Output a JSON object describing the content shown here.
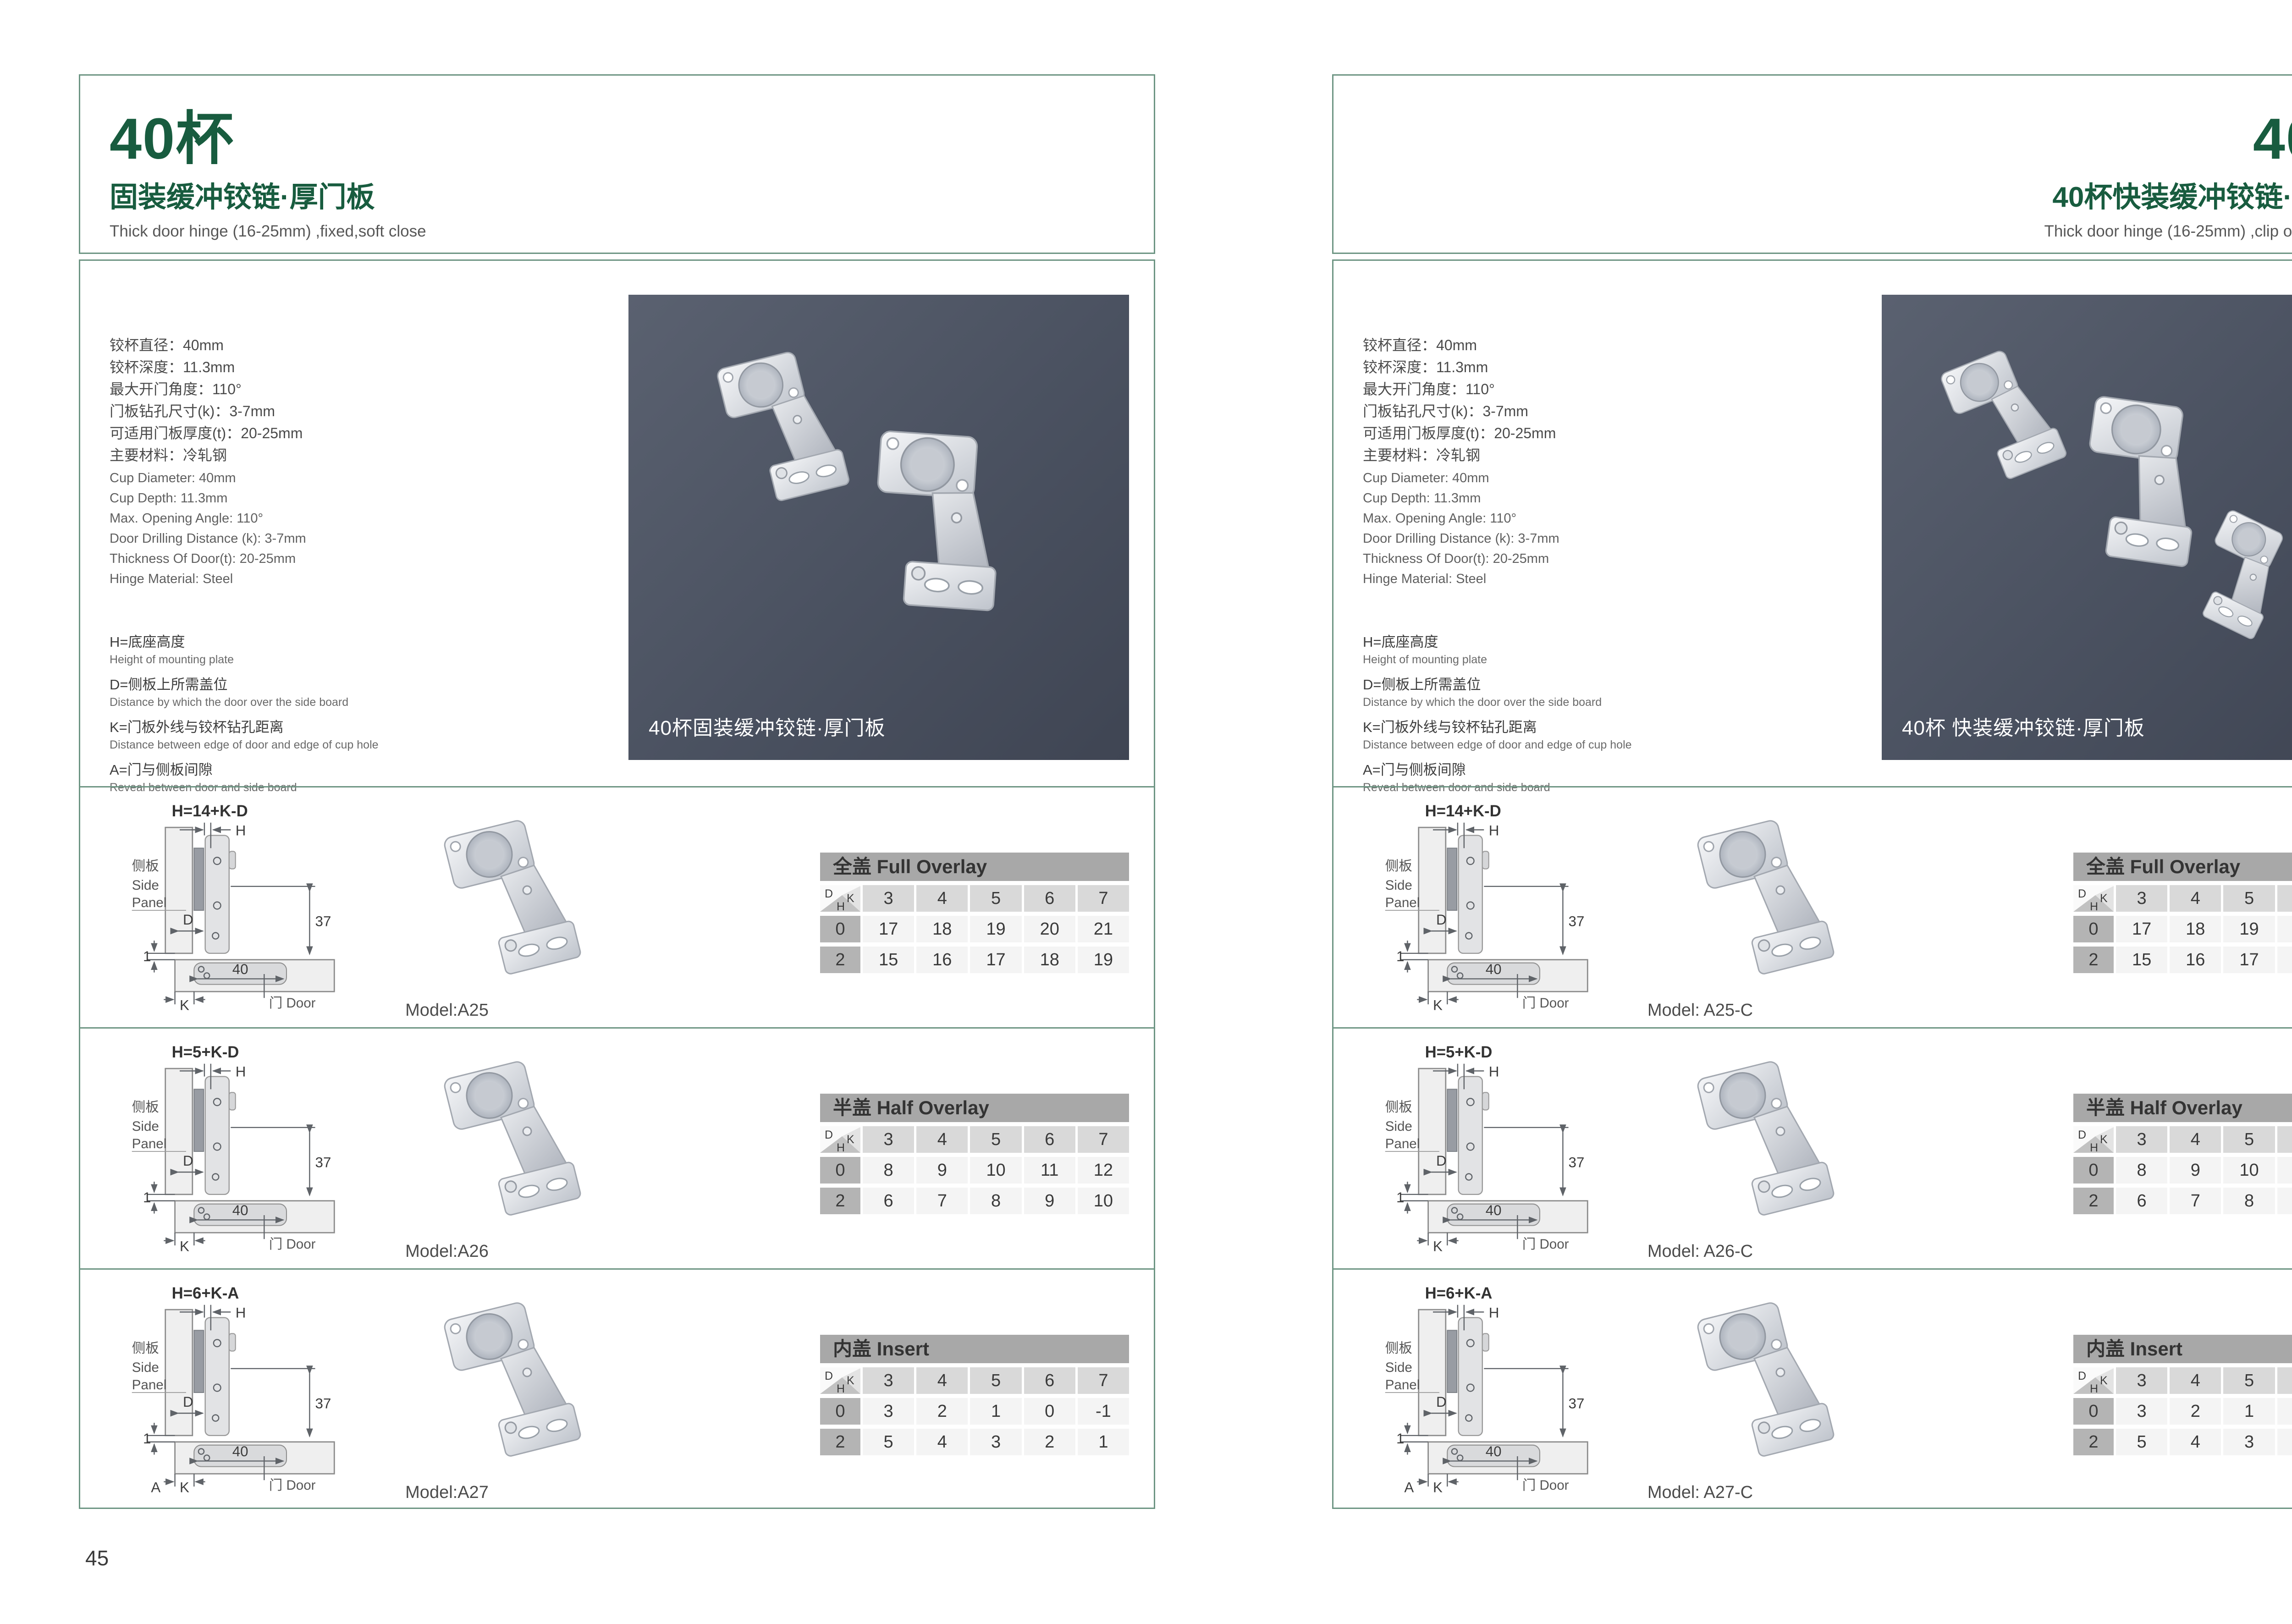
{
  "colors": {
    "brand_green": "#185c3f",
    "frame_green": "#6d9583",
    "photo_bg": "#4a5160",
    "table_title_bg": "#a8a8a8",
    "table_head_bg": "#d9d9d9",
    "table_rowhead_bg": "#b4b4b4",
    "table_cell_bg": "#f4f4f4"
  },
  "diagram_labels": {
    "h": "H",
    "d": "D",
    "k": "K",
    "one": "1",
    "thirty_seven": "37",
    "forty": "40",
    "side_panel_cn": "侧板",
    "side_en_1": "Side",
    "side_en_2": "Panel",
    "door": "门 Door"
  },
  "pages": [
    {
      "page_number": "45",
      "title": "40杯",
      "subtitle": "固装缓冲铰链·厚门板",
      "subtitle_en": "Thick door hinge (16-25mm) ,fixed,soft close",
      "specs_cn": [
        "铰杯直径：40mm",
        "铰杯深度：11.3mm",
        "最大开门角度：110°",
        "门板钻孔尺寸(k)：3-7mm",
        "可适用门板厚度(t)：20-25mm",
        "主要材料：冷轧钢"
      ],
      "specs_en": [
        "Cup Diameter: 40mm",
        "Cup Depth: 11.3mm",
        "Max. Opening Angle: 110°",
        "Door Drilling Distance (k): 3-7mm",
        "Thickness Of Door(t): 20-25mm",
        "Hinge Material: Steel"
      ],
      "legend": [
        {
          "cn": "H=底座高度",
          "en": "Height of mounting plate"
        },
        {
          "cn": "D=侧板上所需盖位",
          "en": "Distance by which the door over the side board"
        },
        {
          "cn": "K=门板外线与铰杯钻孔距离",
          "en": "Distance between edge of door and edge of cup hole"
        },
        {
          "cn": "A=门与侧板间隙",
          "en": "Reveal between door and side board"
        }
      ],
      "photo_caption": "40杯固装缓冲铰链·厚门板",
      "rows": [
        {
          "formula": "H=14+K-D",
          "extra_label": "",
          "model": "Model:A25",
          "table": {
            "title": "全盖 Full Overlay",
            "k_values": [
              "3",
              "4",
              "5",
              "6",
              "7"
            ],
            "row0_label": "0",
            "row0": [
              "17",
              "18",
              "19",
              "20",
              "21"
            ],
            "row2_label": "2",
            "row2": [
              "15",
              "16",
              "17",
              "18",
              "19"
            ]
          }
        },
        {
          "formula": "H=5+K-D",
          "extra_label": "",
          "model": "Model:A26",
          "table": {
            "title": "半盖 Half Overlay",
            "k_values": [
              "3",
              "4",
              "5",
              "6",
              "7"
            ],
            "row0_label": "0",
            "row0": [
              "8",
              "9",
              "10",
              "11",
              "12"
            ],
            "row2_label": "2",
            "row2": [
              "6",
              "7",
              "8",
              "9",
              "10"
            ]
          }
        },
        {
          "formula": "H=6+K-A",
          "extra_label": "A",
          "model": "Model:A27",
          "table": {
            "title": "内盖 Insert",
            "k_values": [
              "3",
              "4",
              "5",
              "6",
              "7"
            ],
            "row0_label": "0",
            "row0": [
              "3",
              "2",
              "1",
              "0",
              "-1"
            ],
            "row2_label": "2",
            "row2": [
              "5",
              "4",
              "3",
              "2",
              "1"
            ]
          }
        }
      ]
    },
    {
      "page_number": "46",
      "title": "40杯",
      "subtitle": "40杯快装缓冲铰链·厚门板",
      "subtitle_en": "Thick door hinge (16-25mm) ,clip on ,soft close",
      "specs_cn": [
        "铰杯直径：40mm",
        "铰杯深度：11.3mm",
        "最大开门角度：110°",
        "门板钻孔尺寸(k)：3-7mm",
        "可适用门板厚度(t)：20-25mm",
        "主要材料：冷轧钢"
      ],
      "specs_en": [
        "Cup Diameter: 40mm",
        "Cup Depth: 11.3mm",
        "Max. Opening Angle: 110°",
        "Door Drilling Distance (k): 3-7mm",
        "Thickness Of Door(t): 20-25mm",
        "Hinge Material: Steel"
      ],
      "legend": [
        {
          "cn": "H=底座高度",
          "en": "Height of mounting plate"
        },
        {
          "cn": "D=侧板上所需盖位",
          "en": "Distance by which the door over the side board"
        },
        {
          "cn": "K=门板外线与铰杯钻孔距离",
          "en": "Distance between edge of door and edge of cup hole"
        },
        {
          "cn": "A=门与侧板间隙",
          "en": "Reveal between door and side board"
        }
      ],
      "photo_caption": "40杯 快装缓冲铰链·厚门板",
      "rows": [
        {
          "formula": "H=14+K-D",
          "extra_label": "",
          "model": "Model: A25-C",
          "table": {
            "title": "全盖 Full Overlay",
            "k_values": [
              "3",
              "4",
              "5",
              "6",
              "7"
            ],
            "row0_label": "0",
            "row0": [
              "17",
              "18",
              "19",
              "20",
              "21"
            ],
            "row2_label": "2",
            "row2": [
              "15",
              "16",
              "17",
              "18",
              "19"
            ]
          }
        },
        {
          "formula": "H=5+K-D",
          "extra_label": "",
          "model": "Model: A26-C",
          "table": {
            "title": "半盖 Half Overlay",
            "k_values": [
              "3",
              "4",
              "5",
              "6",
              "7"
            ],
            "row0_label": "0",
            "row0": [
              "8",
              "9",
              "10",
              "11",
              "12"
            ],
            "row2_label": "2",
            "row2": [
              "6",
              "7",
              "8",
              "9",
              "10"
            ]
          }
        },
        {
          "formula": "H=6+K-A",
          "extra_label": "A",
          "model": "Model: A27-C",
          "table": {
            "title": "内盖 Insert",
            "k_values": [
              "3",
              "4",
              "5",
              "6",
              "7"
            ],
            "row0_label": "0",
            "row0": [
              "3",
              "2",
              "1",
              "0",
              "-1"
            ],
            "row2_label": "2",
            "row2": [
              "5",
              "4",
              "3",
              "2",
              "1"
            ]
          }
        }
      ]
    }
  ]
}
